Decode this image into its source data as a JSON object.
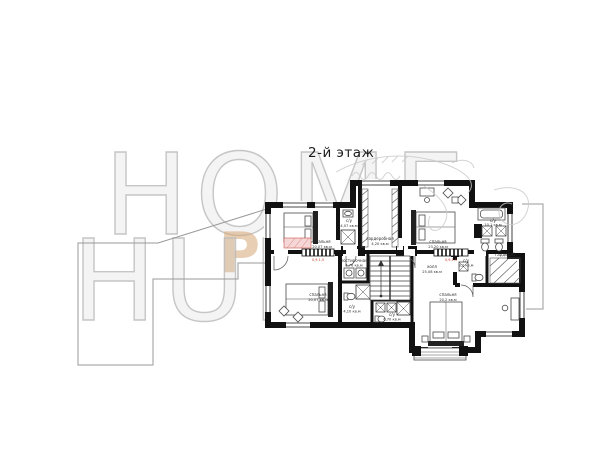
{
  "title": "2-й этаж",
  "watermark": {
    "top_word": "HOME",
    "middle_word": "PLANS",
    "bottom_word": "HUNT"
  },
  "colors": {
    "wall": "#111111",
    "furniture_line": "#4a4a4a",
    "ground_outline": "#9a9a9a",
    "watermark_outline": "#bcbcbc",
    "watermark_accent": "#d6a674",
    "red_accent": "#c0392b",
    "pink_fill": "#f5d7d7"
  },
  "plan": {
    "rooms": [
      {
        "name": "спальня",
        "area": "20,07 кв.м"
      },
      {
        "name": "с/у",
        "area": "4,07 кв.м"
      },
      {
        "name": "гардеробная",
        "area": "4,20 кв.м"
      },
      {
        "name": "спальня",
        "area": "23,20 кв.м"
      },
      {
        "name": "с/у",
        "area": "10,1 кв.м"
      },
      {
        "name": "постирочная",
        "area": "4,76 кв.м"
      },
      {
        "name": "холл",
        "area": "25,08 кв.м"
      },
      {
        "name": "с/у",
        "area": "3,2 кв.м"
      },
      {
        "name": "спальня",
        "area": "20,07 кв.м"
      },
      {
        "name": "с/у",
        "area": "4,10 кв.м"
      },
      {
        "name": "с/у",
        "area": "6,70 кв.м"
      },
      {
        "name": "спальня",
        "area": "20,2 кв.м"
      },
      {
        "name": "гардероб",
        "area": ""
      }
    ],
    "dimension_marks": [
      "0,9-1,5",
      "0,9-1,5"
    ]
  }
}
